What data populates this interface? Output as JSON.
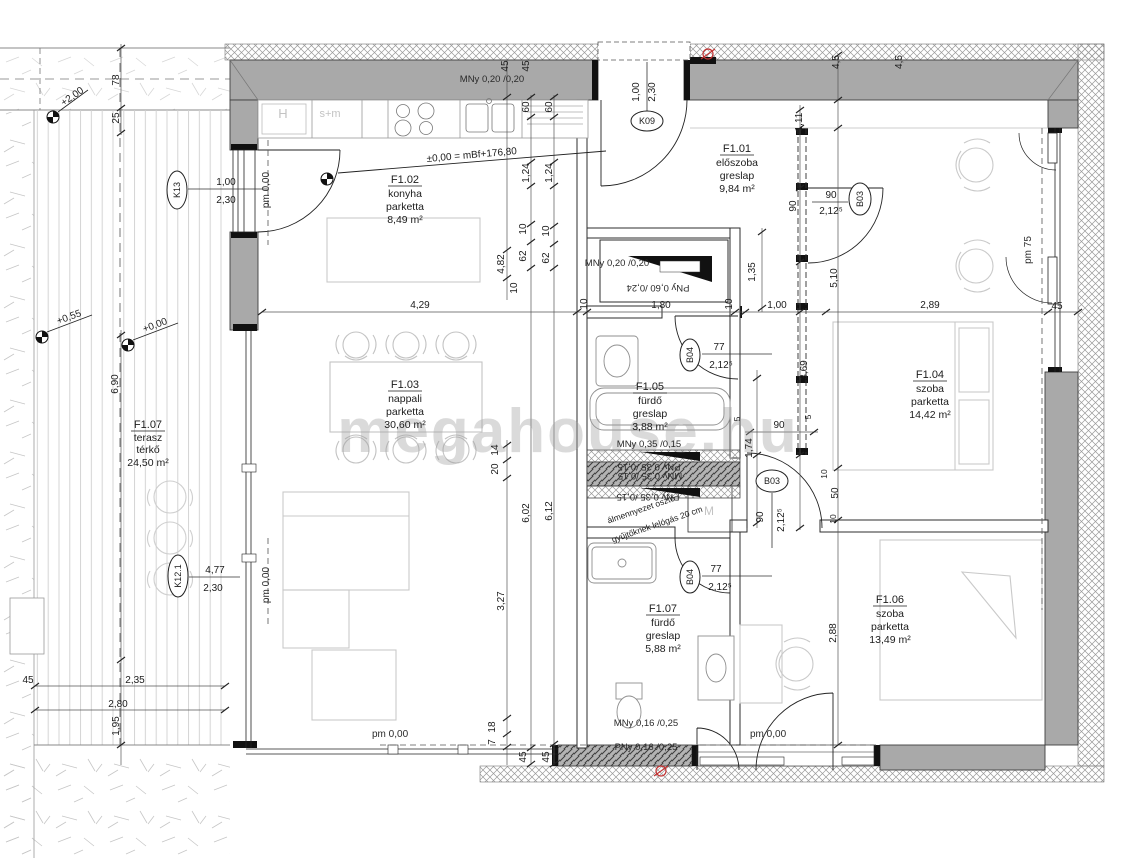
{
  "watermark": "megahouse.hu",
  "rooms": [
    {
      "id": "F1.01",
      "name": "előszoba",
      "finish": "greslap",
      "area": "9,84 m²"
    },
    {
      "id": "F1.02",
      "name": "konyha",
      "finish": "parketta",
      "area": "8,49 m²"
    },
    {
      "id": "F1.03",
      "name": "nappali",
      "finish": "parketta",
      "area": "30,60 m²"
    },
    {
      "id": "F1.04",
      "name": "szoba",
      "finish": "parketta",
      "area": "14,42 m²"
    },
    {
      "id": "F1.05",
      "name": "fürdő",
      "finish": "greslap",
      "area": "3,88 m²"
    },
    {
      "id": "F1.06",
      "name": "szoba",
      "finish": "parketta",
      "area": "13,49 m²"
    },
    {
      "id": "F1.07",
      "name": "fürdő",
      "finish": "greslap",
      "area": "5,88 m²"
    },
    {
      "id": "F1.07",
      "name": "terasz",
      "finish": "térkő",
      "area": "24,50 m²"
    }
  ],
  "door_tags": [
    {
      "code": "K13",
      "w": "1,00",
      "h": "2,30"
    },
    {
      "code": "K09",
      "w": "1,00",
      "h": "2,30"
    },
    {
      "code": "K12.1",
      "w": "4,77",
      "h": "2,30"
    },
    {
      "code": "B03",
      "w": "90",
      "h": "2,12⁵"
    },
    {
      "code": "B03",
      "w": "90",
      "h": "2,12⁵"
    },
    {
      "code": "B04",
      "w": "77",
      "h": "2,12⁵"
    },
    {
      "code": "B04",
      "w": "77",
      "h": "2,12⁵"
    }
  ],
  "levels": {
    "main": "±0,00 = mBf+176,80",
    "path": "+2,00",
    "terrace_a": "+0,55",
    "terrace_b": "+0,00"
  },
  "pm": {
    "k13": "pm 0,00",
    "k121": "pm 0,00",
    "bottom_left": "pm 0,00",
    "bottom_right": "pm 0,00",
    "window": "pm 75"
  },
  "vents": [
    "MNy 0,20 /0,20",
    "MNy 0,20 /0,20",
    "PNy 0,60 /0,24",
    "MNy 0,35 /0,15",
    "PNy 0,35 /0,15",
    "MNy 0,35 /0,15",
    "PNy 0,35 /0,15",
    "MNy 0,16 /0,25",
    "PNy 0,16 /0,25"
  ],
  "ceiling_note": [
    "álmennyezet osztó",
    "gyűjtőknek lelógás 20 cm"
  ],
  "fixtures": {
    "fridge": "H",
    "oven": "s+m",
    "washer": "M"
  },
  "dims": {
    "chain_a": [
      "45",
      "4,82",
      "10",
      "20",
      "14",
      "3,27",
      "18",
      "7"
    ],
    "chain_b": [
      "45",
      "60",
      "1,24",
      "10",
      "62",
      "6,02",
      "45"
    ],
    "chain_c": [
      "60",
      "1,24",
      "10",
      "62",
      "6,12",
      "45"
    ],
    "left": [
      "78",
      "25",
      "6,90",
      "45",
      "2,35",
      "2,80",
      "1,95"
    ],
    "row": [
      "4,29",
      "10",
      "1,80",
      "10",
      "1,00",
      "2,89",
      "45"
    ],
    "right_a": [
      "1,11",
      "90",
      "1,35",
      "3,69",
      "1,74",
      "90",
      "5",
      "5"
    ],
    "right_b": [
      "4,5",
      "4,5",
      "5,10",
      "10",
      "50",
      "10",
      "2,88"
    ]
  }
}
